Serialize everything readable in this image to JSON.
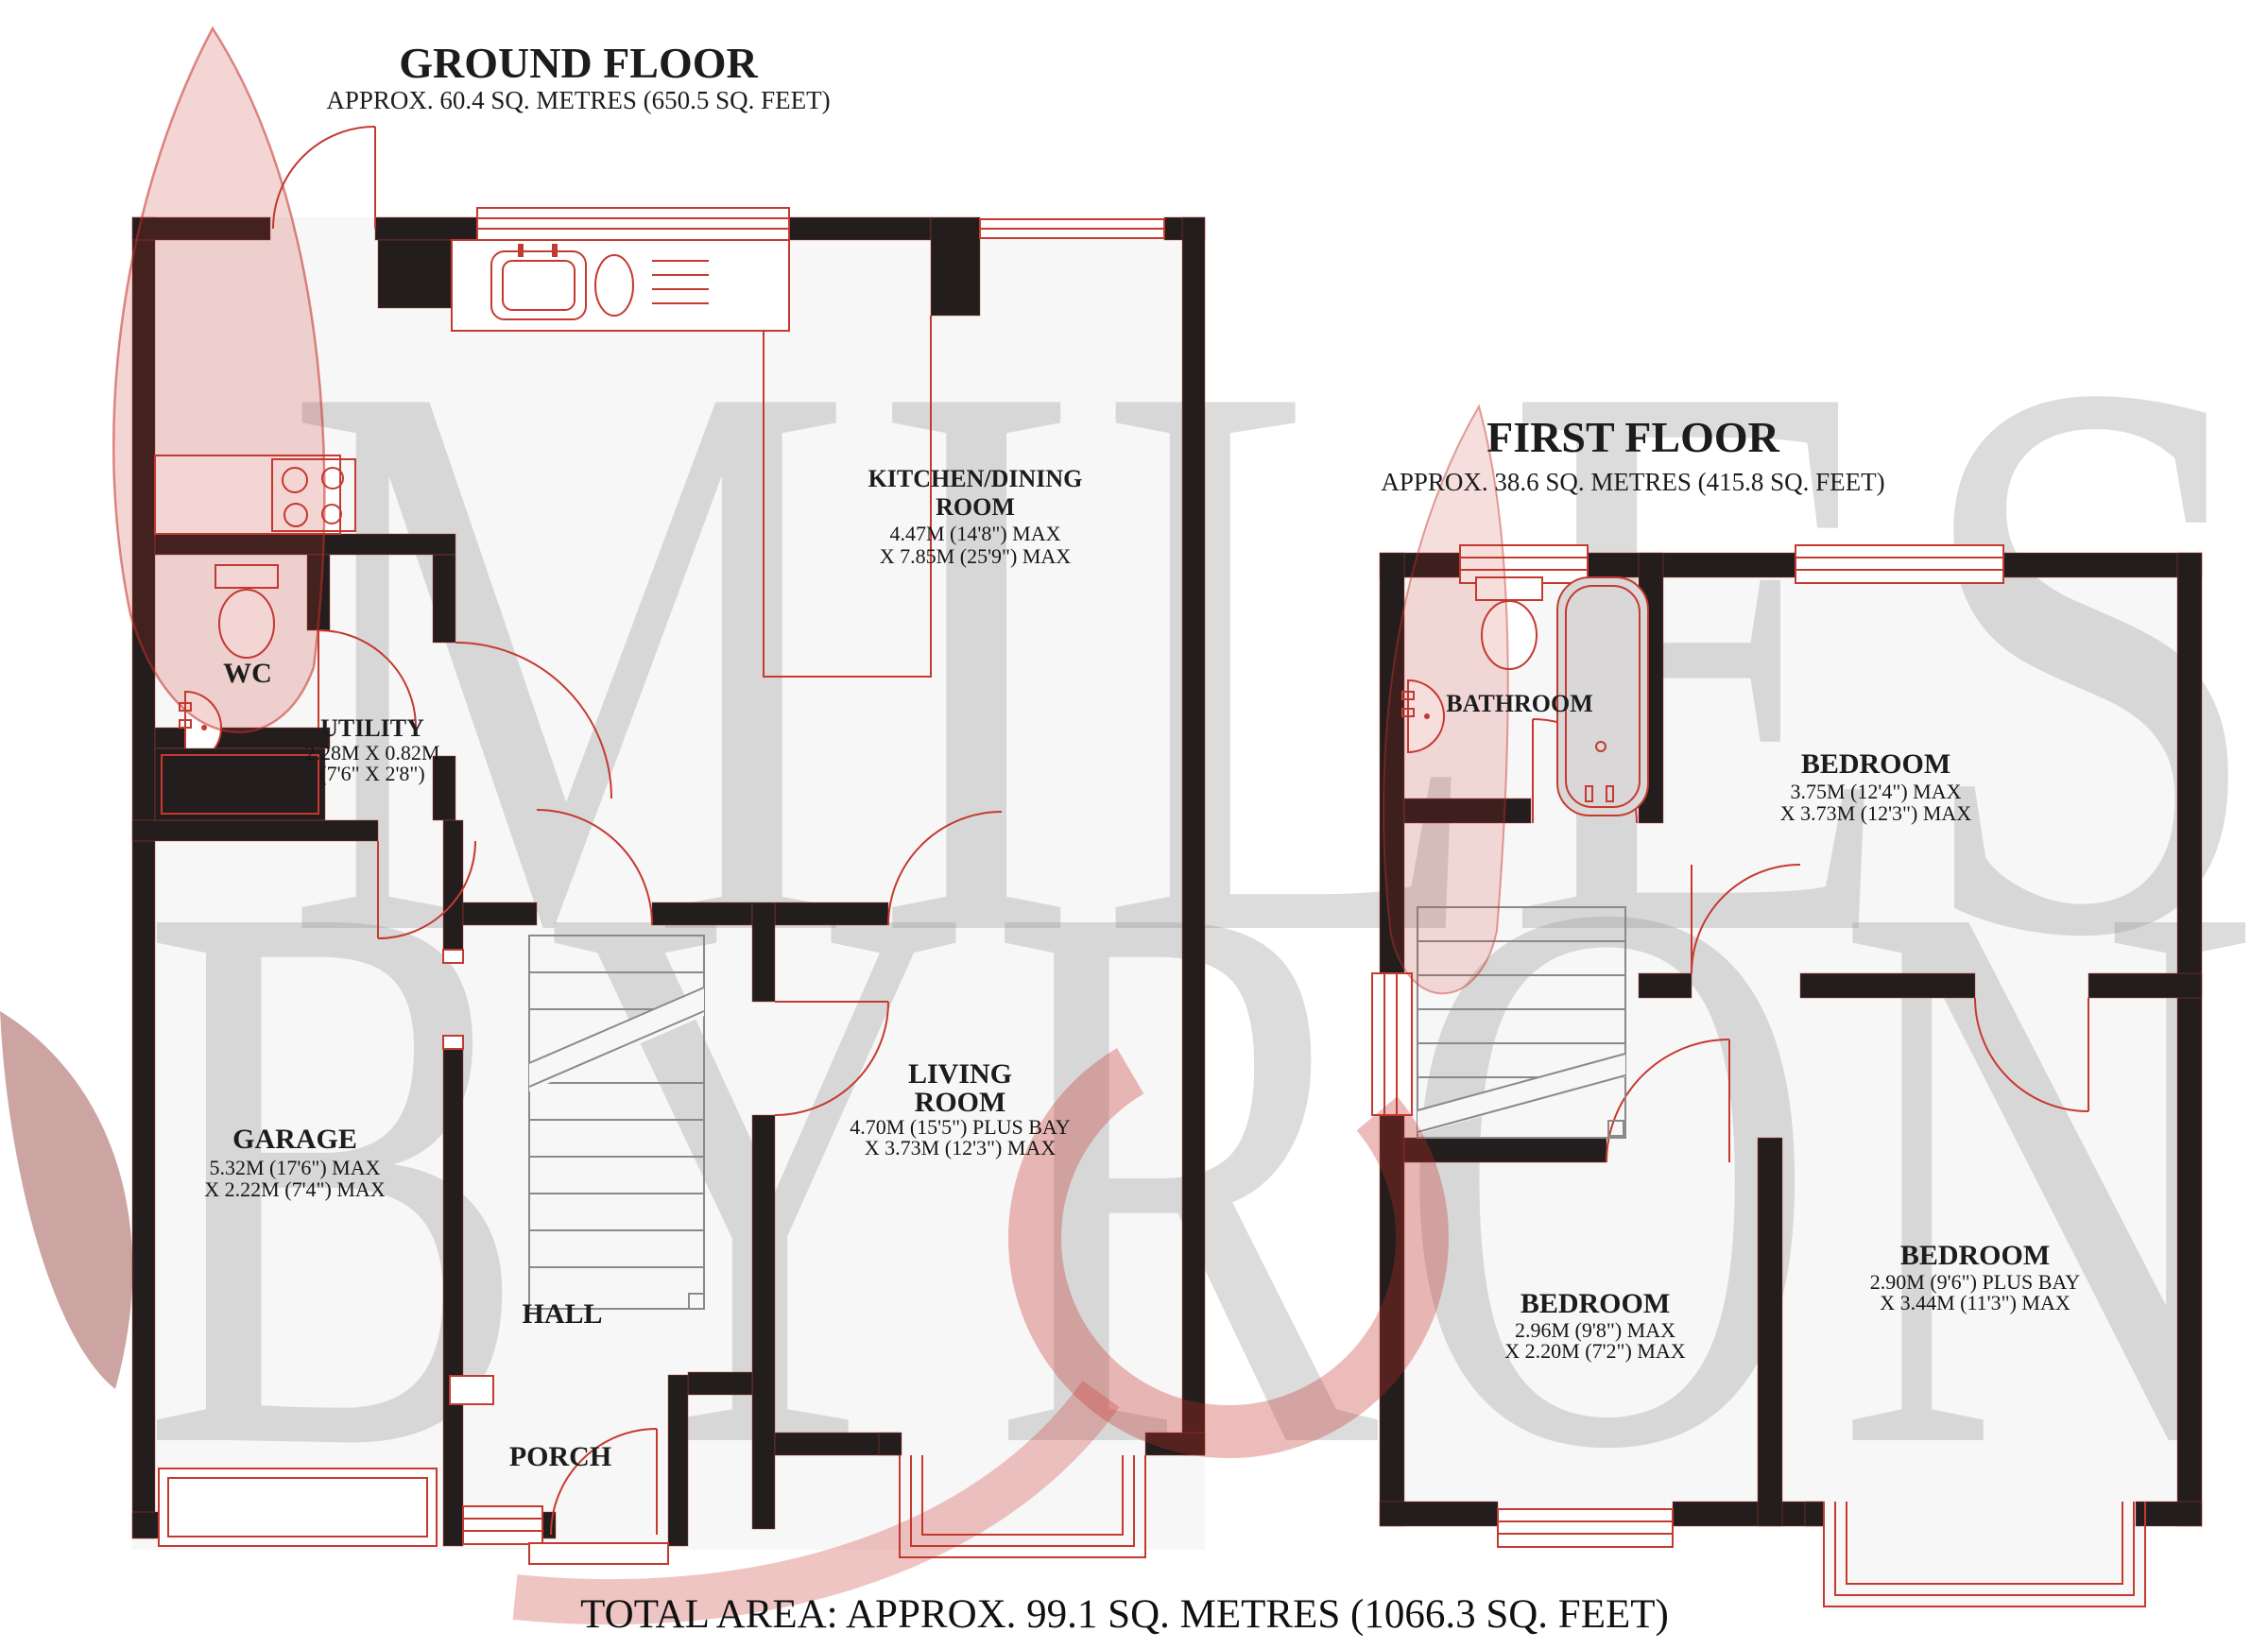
{
  "watermark": {
    "line1": "MILES",
    "line2": "BYRON"
  },
  "total_area_label": "TOTAL AREA: APPROX. 99.1 SQ. METRES (1066.3 SQ. FEET)",
  "ground_floor": {
    "title": "GROUND FLOOR",
    "area": "APPROX. 60.4 SQ. METRES (650.5 SQ. FEET)",
    "rooms": {
      "kitchen_dining": {
        "line1": "KITCHEN/DINING",
        "line2": "ROOM",
        "dim1": "4.47M (14'8\") MAX",
        "dim2": "X 7.85M (25'9\") MAX"
      },
      "wc": {
        "name": "WC"
      },
      "utility": {
        "name": "UTILITY",
        "dim1": "2.28M X 0.82M",
        "dim2": "(7'6\" X 2'8\")"
      },
      "garage": {
        "name": "GARAGE",
        "dim1": "5.32M (17'6\") MAX",
        "dim2": "X 2.22M (7'4\") MAX"
      },
      "living": {
        "line1": "LIVING",
        "line2": "ROOM",
        "dim1": "4.70M (15'5\") PLUS BAY",
        "dim2": "X 3.73M (12'3\") MAX"
      },
      "hall": {
        "name": "HALL"
      },
      "porch": {
        "name": "PORCH"
      }
    }
  },
  "first_floor": {
    "title": "FIRST FLOOR",
    "area": "APPROX. 38.6 SQ. METRES (415.8 SQ. FEET)",
    "rooms": {
      "bathroom": {
        "name": "BATHROOM"
      },
      "bedroom1": {
        "name": "BEDROOM",
        "dim1": "3.75M (12'4\") MAX",
        "dim2": "X 3.73M (12'3\") MAX"
      },
      "bedroom2": {
        "name": "BEDROOM",
        "dim1": "2.90M (9'6\") PLUS BAY",
        "dim2": "X 3.44M (11'3\") MAX"
      },
      "bedroom3": {
        "name": "BEDROOM",
        "dim1": "2.96M (9'8\") MAX",
        "dim2": "X 2.20M (7'2\") MAX"
      }
    }
  },
  "colors": {
    "wall": "#231d1d",
    "fixture_red": "#c53a30",
    "watermark_gray": "#9b9b9b",
    "bath_gray": "#d9d7d7"
  }
}
